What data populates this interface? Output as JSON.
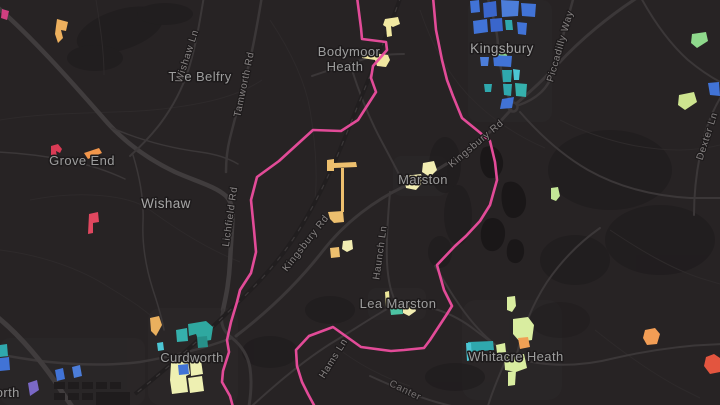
{
  "map": {
    "style": "dark-map-canvas",
    "place_labels": [
      {
        "id": "bodymoor-heath",
        "line1": "Bodymoor",
        "line2": "Heath"
      },
      {
        "id": "kingsbury",
        "text": "Kingsbury"
      },
      {
        "id": "the-belfry",
        "text": "The Belfry"
      },
      {
        "id": "grove-end",
        "text": "Grove End"
      },
      {
        "id": "wishaw",
        "text": "Wishaw"
      },
      {
        "id": "marston",
        "text": "Marston"
      },
      {
        "id": "lea-marston",
        "text": "Lea Marston"
      },
      {
        "id": "curdworth",
        "text": "Curdworth"
      },
      {
        "id": "whitacre-heath",
        "text": "Whitacre Heath"
      },
      {
        "id": "minworth-partial",
        "text": "worth"
      }
    ],
    "road_labels": [
      {
        "id": "wishaw-ln",
        "text": "Wishaw Ln"
      },
      {
        "id": "tamworth-rd",
        "text": "Tamworth Rd"
      },
      {
        "id": "lichfield-rd",
        "text": "Lichfield Rd"
      },
      {
        "id": "kingsbury-rd-sw",
        "text": "Kingsbury Rd"
      },
      {
        "id": "kingsbury-rd-ne",
        "text": "Kingsbury Rd"
      },
      {
        "id": "piccadilly-way",
        "text": "Piccadilly Way"
      },
      {
        "id": "haunch-ln",
        "text": "Haunch Ln"
      },
      {
        "id": "hams-ln",
        "text": "Hams Ln"
      },
      {
        "id": "dexter-ln",
        "text": "Dexter Ln"
      },
      {
        "id": "canter-partial",
        "text": "Canter"
      }
    ],
    "colors": {
      "background": "#272324",
      "woodland": "#1d1a1b",
      "water": "#1a1718",
      "road": "#3b3738",
      "railway": "#211e1f",
      "boundary_pink": "#ea4d9d",
      "label_place": "#9d9d9d",
      "label_road": "#868282",
      "parcel_blue": "#4173d6",
      "parcel_teal": "#2fa8ad",
      "parcel_cyan": "#4cc6d4",
      "parcel_mint": "#4dc4a4",
      "parcel_green": "#8fd98c",
      "parcel_yellow_green": "#d9eda0",
      "parcel_cream": "#f2edb2",
      "parcel_yellow": "#f2e9a2",
      "parcel_tan": "#edbf6e",
      "parcel_orange": "#f29d55",
      "parcel_red": "#e0475f",
      "parcel_red_orange": "#e3553f",
      "parcel_magenta": "#cf3f80",
      "parcel_purple": "#7a68c6"
    }
  }
}
